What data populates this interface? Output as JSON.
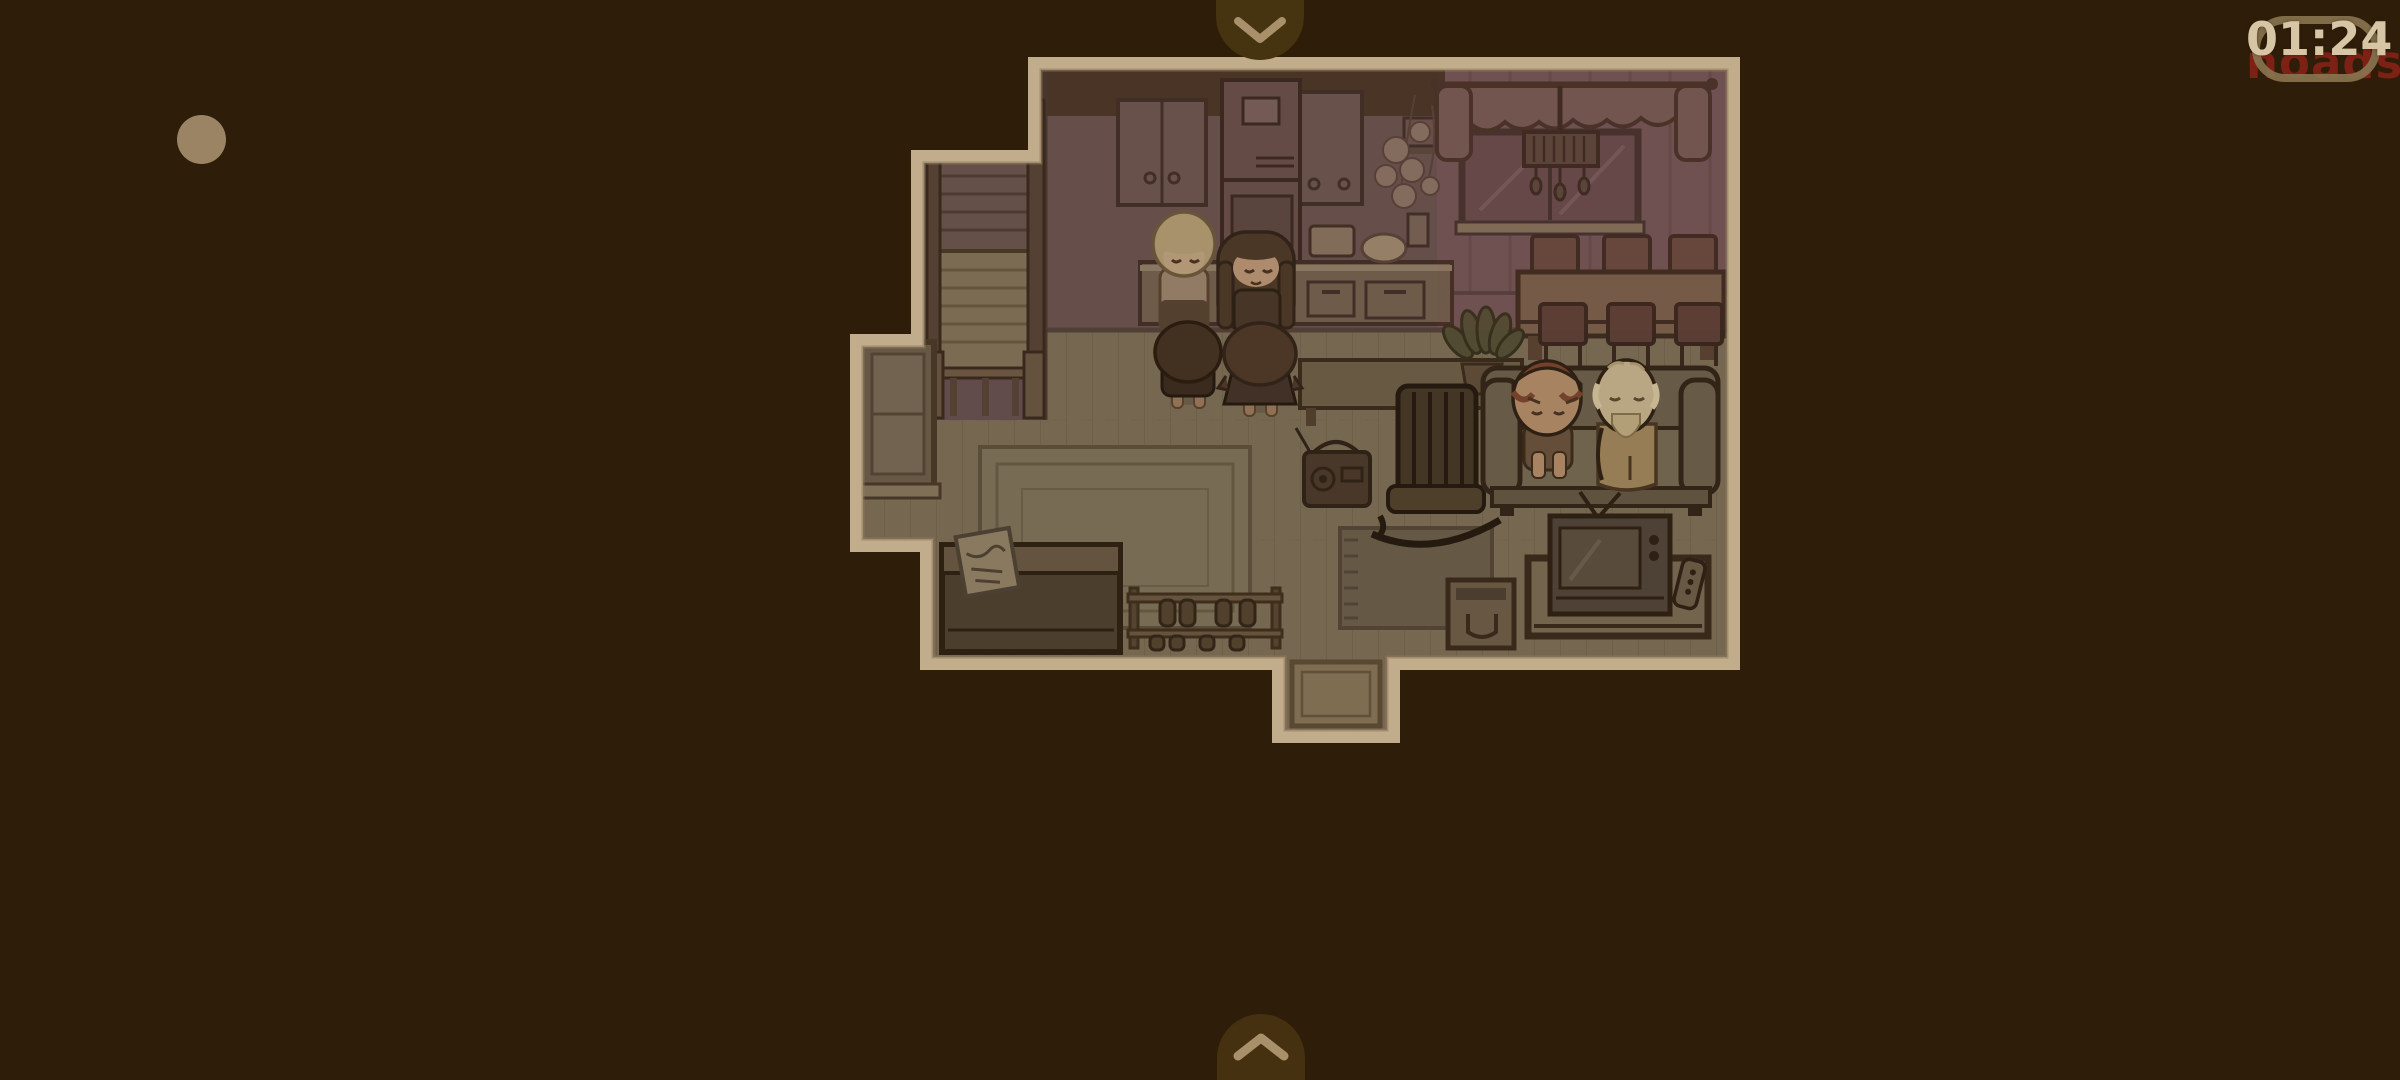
{
  "screen": {
    "width": 2400,
    "height": 1080
  },
  "palette": {
    "background": "#2e1d08",
    "house_border": "#c1ac8b",
    "floor": "#7e7059",
    "wall_kitchen": "#6d5452",
    "wall_dining": "#74585a",
    "tab_background": "#463310",
    "chevron": "#a8906a",
    "timer_text": "#d6c6a6",
    "watermark_text": "#7d2115",
    "capsule_outline": "#8a7650",
    "corner_dot": "#9a8464"
  },
  "hud": {
    "timer": {
      "value": "01:24"
    },
    "watermark": {
      "value": "noads"
    },
    "swipe_down_tab": {
      "icon": "chevron-down"
    },
    "swipe_up_tab": {
      "icon": "chevron-up"
    },
    "corner_dot": {
      "icon": "dot"
    }
  },
  "scene": {
    "description": "top-down pixel-art house interior in dim sepia lighting",
    "rooms": [
      "stair-hall",
      "kitchen",
      "dining-area",
      "living-room",
      "entryway"
    ],
    "characters": [
      {
        "name": "blonde-kid",
        "hair_color": "#b5a077",
        "location": "kitchen",
        "facing": "down"
      },
      {
        "name": "long-haired-girl",
        "hair_color": "#4f3a29",
        "location": "kitchen",
        "facing": "down"
      },
      {
        "name": "brown-haired-boy",
        "hair_color": "#453324",
        "location": "kitchen",
        "facing": "up"
      },
      {
        "name": "brown-haired-girl",
        "hair_color": "#50392a",
        "location": "kitchen",
        "facing": "up"
      },
      {
        "name": "sad-brown-haired-kid",
        "hair_color": "#7c4630",
        "location": "couch",
        "facing": "down"
      },
      {
        "name": "bearded-elder",
        "hair_color": "#cbb995",
        "location": "couch",
        "facing": "down"
      }
    ],
    "furniture": [
      "staircase",
      "kitchen-cabinets",
      "refrigerator",
      "kitchen-counter",
      "hanging-flowers",
      "curtained-window",
      "chandelier",
      "dining-table",
      "dining-chairs",
      "console-table",
      "potted-plant",
      "radio",
      "rocking-chair",
      "couch",
      "tv",
      "tv-stand",
      "remote",
      "cardboard-box",
      "piano",
      "sheet-music",
      "shoe-rack",
      "area-rug",
      "fringe-rug",
      "doormat",
      "hall-window"
    ]
  }
}
